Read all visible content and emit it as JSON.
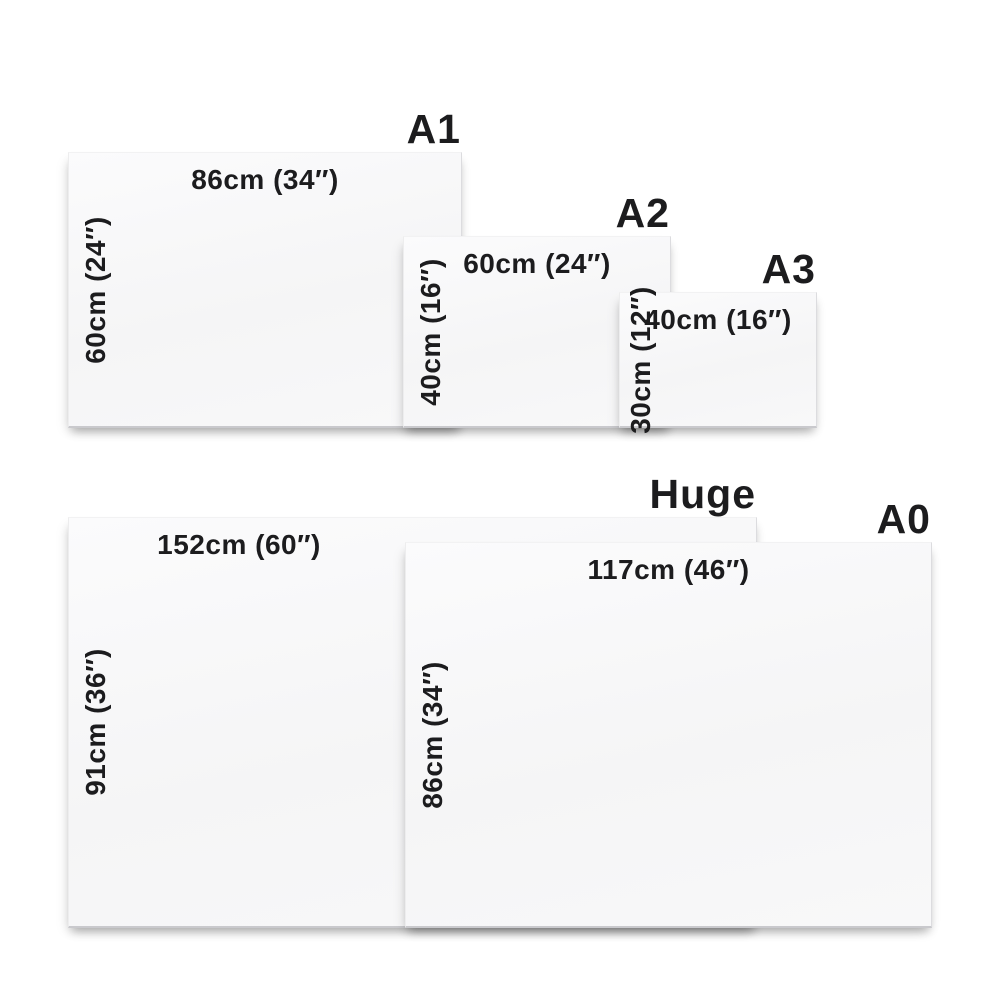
{
  "page": {
    "background_color": "#ffffff",
    "text_color": "#1c1c1e",
    "panel_fill_color": "#f6f6f7"
  },
  "sizes": [
    {
      "id": "a1",
      "title": "A1",
      "width_label": "86cm (34″)",
      "height_label": "60cm (24″)"
    },
    {
      "id": "a2",
      "title": "A2",
      "width_label": "60cm (24″)",
      "height_label": "40cm (16″)"
    },
    {
      "id": "a3",
      "title": "A3",
      "width_label": "40cm (16″)",
      "height_label": "30cm (12″)"
    },
    {
      "id": "huge",
      "title": "Huge",
      "width_label": "152cm (60″)",
      "height_label": "91cm (36″)"
    },
    {
      "id": "a0",
      "title": "A0",
      "width_label": "117cm (46″)",
      "height_label": "86cm (34″)"
    }
  ]
}
